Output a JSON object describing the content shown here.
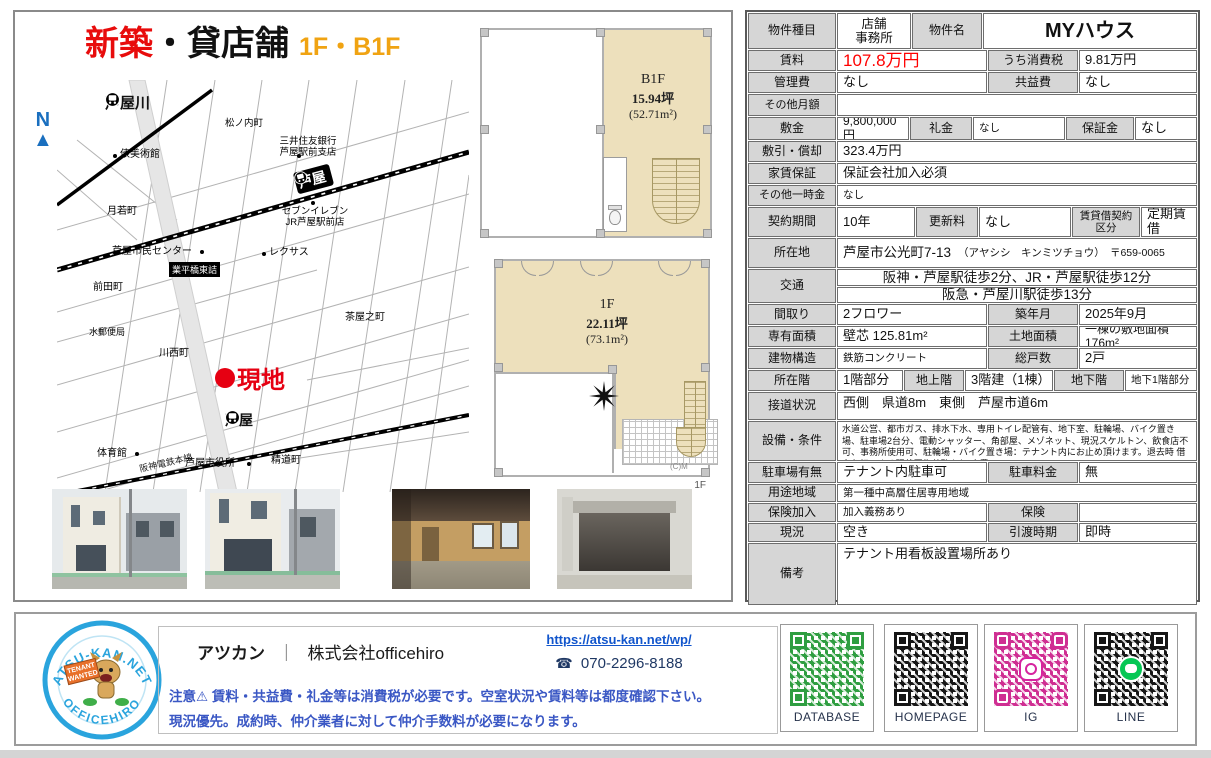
{
  "title": {
    "red": "新築",
    "black": "・貸店舗",
    "sub": "1F・B1F"
  },
  "compass": {
    "n": "N",
    "arrow": "▲"
  },
  "map": {
    "hankyu_station": "芦屋川",
    "matsunouchi": "松ノ内町",
    "museum": "俵美術館",
    "bank": "三井住友銀行\n芦屋駅前支店",
    "jr_station": "芦屋",
    "seven_eleven": "セブンイレブン\nJR芦屋駅前店",
    "lexus": "レクサス",
    "narihira_box": "業平橋東詰",
    "tsukiwaka": "月若町",
    "civic_center": "芦屋市民センター",
    "chaya": "茶屋之町",
    "maeda": "前田町",
    "post_office": "水郵便局",
    "kawanishi": "川西町",
    "site_marker": "現地",
    "hanshin_station": "芦屋",
    "gym": "体育館",
    "hanshin_line": "阪神電鉄本線",
    "city_hall": "芦屋市役所",
    "seido": "精道町",
    "credit": "(C)M"
  },
  "floorplans": {
    "b1f": {
      "name": "B1F",
      "tsubo": "15.94坪",
      "m2": "(52.71m²)"
    },
    "f1": {
      "name": "1F",
      "tsubo": "22.11坪",
      "m2": "(73.1m²)",
      "corner": "1F"
    }
  },
  "table": {
    "r1": {
      "l1": "物件種目",
      "v1": "店舗\n事務所",
      "l2": "物件名",
      "v2": "MYハウス"
    },
    "r2": {
      "l1": "賃料",
      "v1": "107.8万円",
      "l2": "うち消費税",
      "v2": "9.81万円"
    },
    "r3": {
      "l1": "管理費",
      "v1": "なし",
      "l2": "共益費",
      "v2": "なし"
    },
    "r4": {
      "l1": "その他月額",
      "v1": ""
    },
    "r5": {
      "l1": "敷金",
      "v1": "9,800,000円",
      "l2": "礼金",
      "v2": "なし",
      "l3": "保証金",
      "v3": "なし"
    },
    "r6": {
      "l1": "敷引・償却",
      "v1": "323.4万円"
    },
    "r7": {
      "l1": "家賃保証",
      "v1": "保証会社加入必須"
    },
    "r8": {
      "l1": "その他一時金",
      "v1": "なし"
    },
    "r9": {
      "l1": "契約期間",
      "v1": "10年",
      "l2": "更新料",
      "v2": "なし",
      "l3": "賃貸借契約\n区分",
      "v3": "定期賃借"
    },
    "r10": {
      "l1": "所在地",
      "v1": "芦屋市公光町7-13",
      "v1b": "（アヤシシ　キンミツチョウ）　〒659-0065"
    },
    "r11": {
      "l1": "交通",
      "v1": "阪神・芦屋駅徒歩2分、JR・芦屋駅徒歩12分",
      "v2": "阪急・芦屋川駅徒歩13分"
    },
    "r12": {
      "l1": "間取り",
      "v1": "2フロワー",
      "l2": "築年月",
      "v2": "2025年9月"
    },
    "r13": {
      "l1": "専有面積",
      "v1": "壁芯 125.81m²",
      "l2": "土地面積",
      "v2": "一棟の敷地面積176m²"
    },
    "r14": {
      "l1": "建物構造",
      "v1": "鉄筋コンクリート",
      "l2": "総戸数",
      "v2": "2戸"
    },
    "r15": {
      "l1": "所在階",
      "v1": "1階部分",
      "l2": "地上階",
      "v2": "3階建（1棟）",
      "l3": "地下階",
      "v3": "地下1階部分"
    },
    "r16": {
      "l1": "接道状況",
      "v1": "西側　県道8m　東側　芦屋市道6m"
    },
    "r17": {
      "l1": "設備・条件",
      "v1": "水道公営、都市ガス、排水下水、専用トイレ配管有、地下室、駐輪場、バイク置き場、駐車場2台分、電動シャッター、角部屋、メゾネット、現況スケルトン、飲食店不可、事務所使用可、駐輪場・バイク置き場：テナント内にお止め頂けます。退去時 借主負担による現状回復義務あり(実費)"
    },
    "r18": {
      "l1": "駐車場有無",
      "v1": "テナント内駐車可",
      "l2": "駐車料金",
      "v2": "無"
    },
    "r19": {
      "l1": "用途地域",
      "v1": "第一種中高層住居専用地域"
    },
    "r20": {
      "l1": "保険加入",
      "v1": "加入義務あり",
      "l2": "保険",
      "v2": ""
    },
    "r21": {
      "l1": "現況",
      "v1": "空き",
      "l2": "引渡時期",
      "v2": "即時"
    },
    "r22": {
      "l1": "備考",
      "v1": "テナント用看板設置場所あり"
    }
  },
  "footer": {
    "logo_top": "ATSU-KAN.NET",
    "logo_bottom": "OFFICEHIRO",
    "logo_badge1": "TENANT",
    "logo_badge2": "WANTED",
    "company_name": "アツカン",
    "company_sep": "｜",
    "company_legal": "株式会社officehiro",
    "url": "https://atsu-kan.net/wp/",
    "phone_icon": "☎",
    "phone": "070-2296-8188",
    "note1": "注意⚠ 賃料・共益費・礼金等は消費税が必要です。空室状況や賃料等は都度確認下さい。",
    "note2": "現況優先。成約時、仲介業者に対して仲介手数料が必要になります。",
    "qr": [
      {
        "label": "DATABASE"
      },
      {
        "label": "HOMEPAGE"
      },
      {
        "label": "IG"
      },
      {
        "label": "LINE"
      }
    ]
  }
}
